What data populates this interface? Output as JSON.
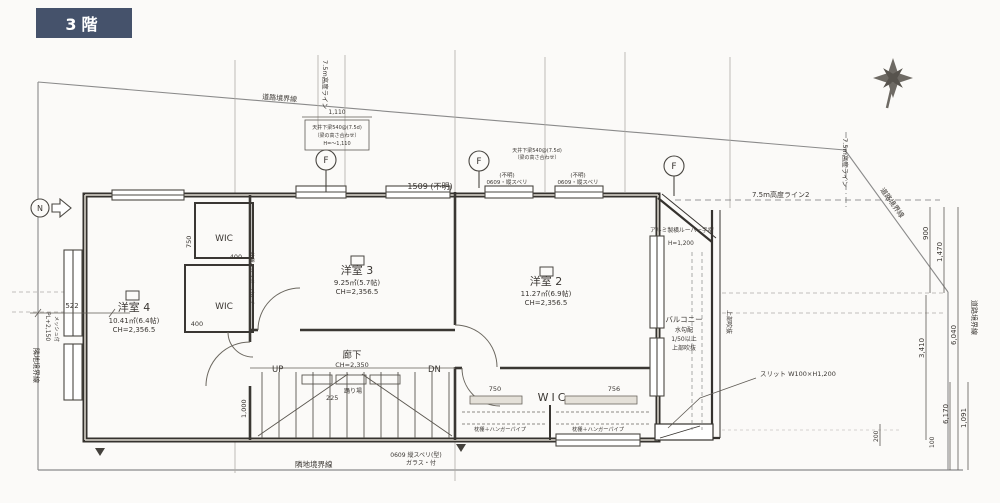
{
  "badge": {
    "label": "3階"
  },
  "colors": {
    "badge_bg": "#45526b",
    "badge_text": "#ffffff",
    "paper": "#fbfaf8",
    "ink": "#3b3733"
  },
  "rooms": {
    "r4": {
      "name": "洋室 4",
      "area": "10.41㎡(6.4帖)",
      "ch": "CH=2,356.5"
    },
    "r3": {
      "name": "洋室 3",
      "area": "9.25㎡(5.7帖)",
      "ch": "CH=2,356.5"
    },
    "r2": {
      "name": "洋室 2",
      "area": "11.27㎡(6.9帖)",
      "ch": "CH=2,356.5"
    },
    "hall": {
      "name": "廊下",
      "ch": "CH=2,350"
    },
    "wic": {
      "label": "WIC"
    },
    "balcony": {
      "name": "バルコニー",
      "note1": "水勾配",
      "note2": "1/50以上",
      "note3": "上部吹抜",
      "side": "上部吹抜"
    }
  },
  "stairs": {
    "up": "UP",
    "dn": "DN",
    "tread": "225",
    "landing": "踊り場"
  },
  "boundaries": {
    "road": "道路境界線",
    "neighbor": "隣地境界線"
  },
  "height_lines": {
    "main": "7.5m高度ライン",
    "second": "7.5m高度ライン2"
  },
  "annotations": {
    "beam1": {
      "l1": "天井下梁540@(7.5d)",
      "l2": "（梁の高さ合わせ）",
      "l3": "H=～1,110"
    },
    "beam2": {
      "l1": "天井下梁540@(7.5d)",
      "l2": "（梁の高さ合わせ）"
    },
    "louver": {
      "l1": "アルミ製横ルーバー手摺",
      "l2": "H=1,200"
    },
    "slit": "スリット W100×H1,200",
    "window_tag": "(不明)",
    "window_0609": "0609・縦スベリ",
    "window_bottom": {
      "l1": "0609 縦スベリ(型)",
      "l2": "ガラス・付"
    },
    "closet_rod": "枕棚＋ハンガーパイプ",
    "mesh": {
      "l1": "PL+2,150",
      "l2": "メッシュ付"
    },
    "marker_f": "F",
    "marker_left": "N"
  },
  "dims": {
    "d522": "522",
    "d750": "750",
    "d400": "400",
    "d1000": "1,000",
    "d756": "756",
    "d1509": "1509 (不明)",
    "d1110": "1,110",
    "d900": "900",
    "d1470": "1,470",
    "d3410": "3,410",
    "d6040": "6,040",
    "d6170": "6,170",
    "d1091": "1,091",
    "d200": "200",
    "d100": "100"
  }
}
